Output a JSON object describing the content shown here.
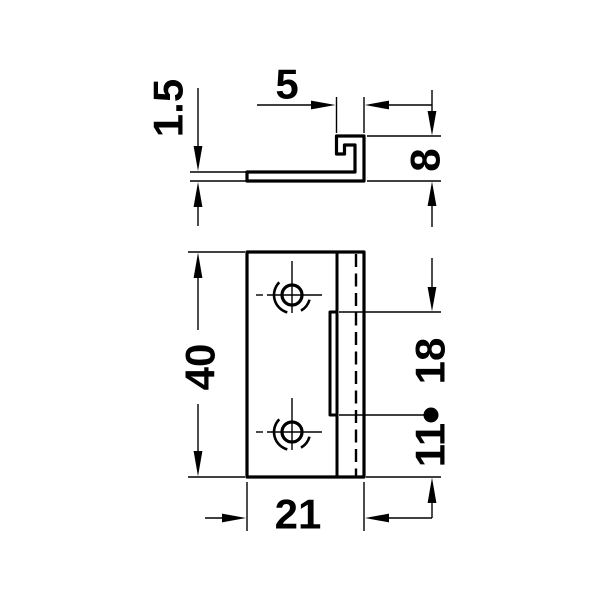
{
  "colors": {
    "background": "#ffffff",
    "line": "#000000"
  },
  "side_view": {
    "thickness": "1.5",
    "hook_width": "5",
    "hook_height": "8"
  },
  "front_view": {
    "plate_height": "40",
    "plate_width": "21",
    "flange_length": "18",
    "flange_bottom_offset": "11"
  }
}
